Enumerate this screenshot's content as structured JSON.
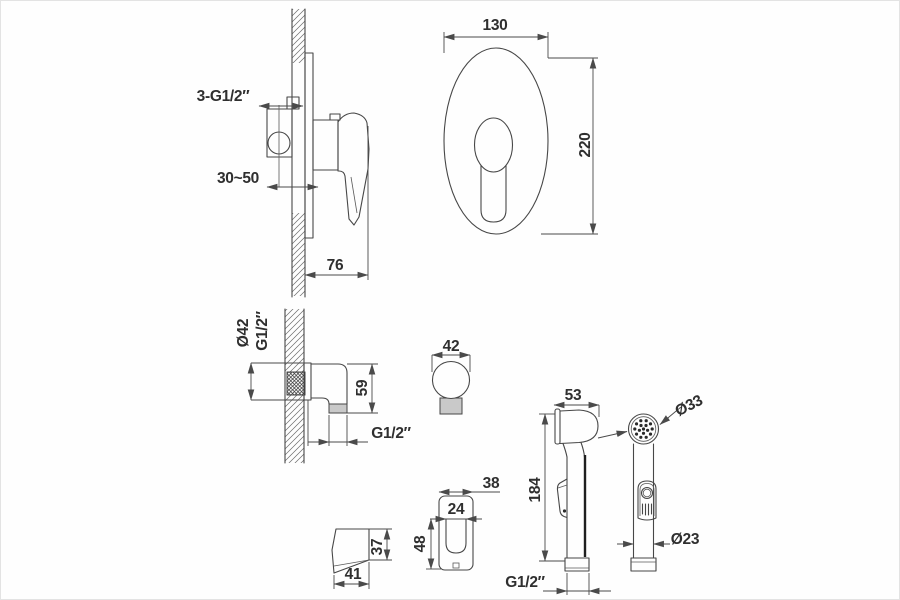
{
  "title": "Concealed bidet mixer set - dimensional technical drawing",
  "colors": {
    "line": "#474747",
    "dim_line": "#4a4a4a",
    "gray_fill": "#c9c9c9",
    "background": "#fefefe"
  },
  "views": {
    "mixer_side": {
      "thread": "3-G1/2″",
      "depth_range": "30~50",
      "projection": "76"
    },
    "mixer_front": {
      "width": "130",
      "height": "220"
    },
    "elbow": {
      "flange_diameter": "Ø42",
      "inlet_thread": "G1/2″",
      "height": "59",
      "outlet_thread": "G1/2″"
    },
    "outlet_front": {
      "diameter": "42"
    },
    "holder_side": {
      "height": "37",
      "depth": "41"
    },
    "holder_front": {
      "width": "38",
      "slot_width": "24",
      "height": "48"
    },
    "sprayer_side": {
      "head_depth": "53",
      "length": "184",
      "thread": "G1/2″"
    },
    "sprayer_front": {
      "face_diameter": "Ø33",
      "handle_diameter": "Ø23"
    }
  }
}
